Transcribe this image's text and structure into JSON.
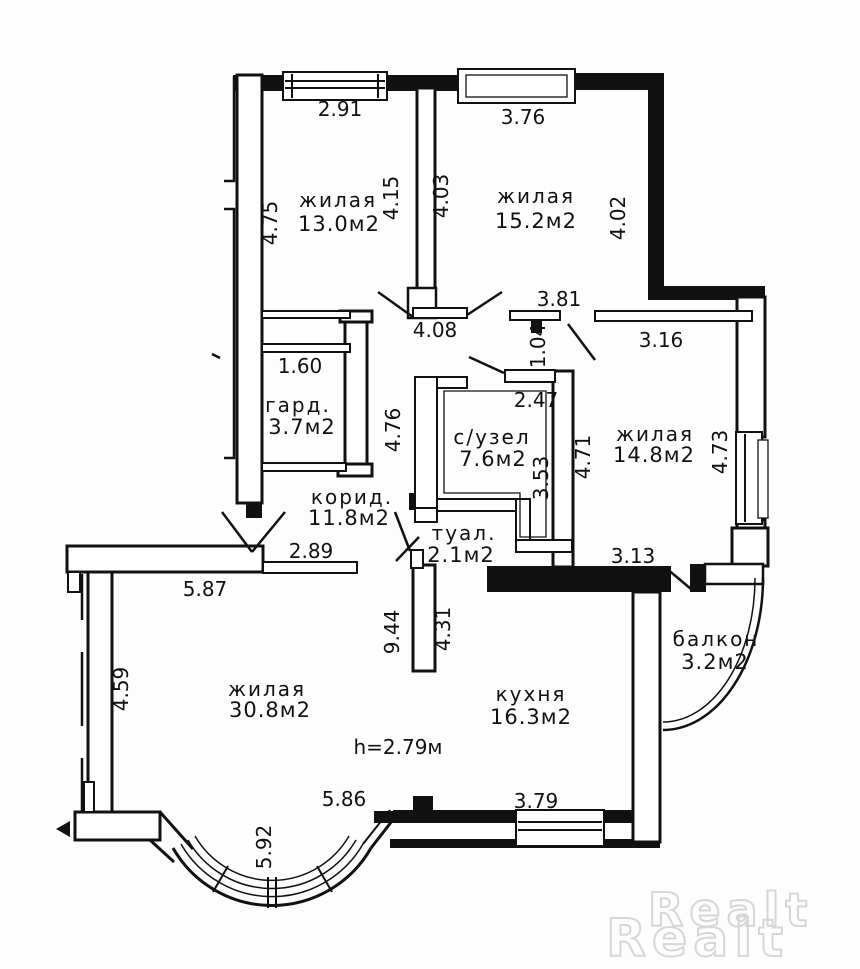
{
  "plan": {
    "type": "apartment-floor-plan",
    "rooms": [
      {
        "id": "living-1",
        "name": "жилая",
        "area": "13.0м2",
        "nx": 338,
        "ny": 207,
        "ax": 339,
        "ay": 231
      },
      {
        "id": "living-2",
        "name": "жилая",
        "area": "15.2м2",
        "nx": 536,
        "ny": 203,
        "ax": 536,
        "ay": 228
      },
      {
        "id": "wardrobe",
        "name": "гард.",
        "area": "3.7м2",
        "nx": 298,
        "ny": 412,
        "ax": 302,
        "ay": 434
      },
      {
        "id": "bathroom",
        "name": "с/узел",
        "area": "7.6м2",
        "nx": 492,
        "ny": 444,
        "ax": 493,
        "ay": 466
      },
      {
        "id": "living-3",
        "name": "жилая",
        "area": "14.8м2",
        "nx": 655,
        "ny": 441,
        "ax": 654,
        "ay": 462
      },
      {
        "id": "corridor",
        "name": "корид.",
        "area": "11.8м2",
        "nx": 352,
        "ny": 504,
        "ax": 349,
        "ay": 525
      },
      {
        "id": "toilet",
        "name": "туал.",
        "area": "2.1м2",
        "nx": 464,
        "ny": 540,
        "ax": 461,
        "ay": 562
      },
      {
        "id": "living-4",
        "name": "жилая",
        "area": "30.8м2",
        "nx": 267,
        "ny": 696,
        "ax": 270,
        "ay": 717
      },
      {
        "id": "kitchen",
        "name": "кухня",
        "area": "16.3м2",
        "nx": 531,
        "ny": 701,
        "ax": 531,
        "ay": 724
      },
      {
        "id": "balcony",
        "name": "балкон",
        "area": "3.2м2",
        "nx": 716,
        "ny": 646,
        "ax": 715,
        "ay": 669
      }
    ],
    "dimensions": [
      {
        "text": "2.91",
        "x": 340,
        "y": 116,
        "rot": 0
      },
      {
        "text": "3.76",
        "x": 523,
        "y": 124,
        "rot": 0
      },
      {
        "text": "4.75",
        "x": 277,
        "y": 223,
        "rot": -90
      },
      {
        "text": "4.15",
        "x": 398,
        "y": 198,
        "rot": -90
      },
      {
        "text": "4.03",
        "x": 448,
        "y": 196,
        "rot": -90
      },
      {
        "text": "4.02",
        "x": 625,
        "y": 218,
        "rot": -90
      },
      {
        "text": "4.08",
        "x": 435,
        "y": 337,
        "rot": 0
      },
      {
        "text": "3.81",
        "x": 559,
        "y": 306,
        "rot": 0
      },
      {
        "text": "1.04",
        "x": 545,
        "y": 346,
        "rot": -90
      },
      {
        "text": "3.16",
        "x": 661,
        "y": 347,
        "rot": 0
      },
      {
        "text": "1.60",
        "x": 300,
        "y": 373,
        "rot": 0
      },
      {
        "text": "2.47",
        "x": 536,
        "y": 407,
        "rot": 0
      },
      {
        "text": "4.76",
        "x": 400,
        "y": 430,
        "rot": -90
      },
      {
        "text": "3.53",
        "x": 548,
        "y": 478,
        "rot": -90
      },
      {
        "text": "4.71",
        "x": 590,
        "y": 457,
        "rot": -90
      },
      {
        "text": "4.73",
        "x": 727,
        "y": 452,
        "rot": -90
      },
      {
        "text": "2.89",
        "x": 311,
        "y": 558,
        "rot": 0
      },
      {
        "text": "5.87",
        "x": 205,
        "y": 596,
        "rot": 0
      },
      {
        "text": "3.13",
        "x": 633,
        "y": 563,
        "rot": 0
      },
      {
        "text": "9.44",
        "x": 399,
        "y": 632,
        "rot": -90
      },
      {
        "text": "4.31",
        "x": 450,
        "y": 629,
        "rot": -90
      },
      {
        "text": "4.59",
        "x": 128,
        "y": 689,
        "rot": -90
      },
      {
        "text": "5.86",
        "x": 344,
        "y": 806,
        "rot": 0
      },
      {
        "text": "3.79",
        "x": 536,
        "y": 808,
        "rot": 0
      },
      {
        "text": "5.92",
        "x": 271,
        "y": 847,
        "rot": -90
      }
    ],
    "ceiling_height": {
      "text": "h=2.79м",
      "x": 398,
      "y": 754
    },
    "watermark": {
      "line1": "Realt",
      "line2": "Realt"
    },
    "colors": {
      "wall": "#111111",
      "paper": "#fdfdfd",
      "watermark": "#d6d6d6"
    }
  }
}
